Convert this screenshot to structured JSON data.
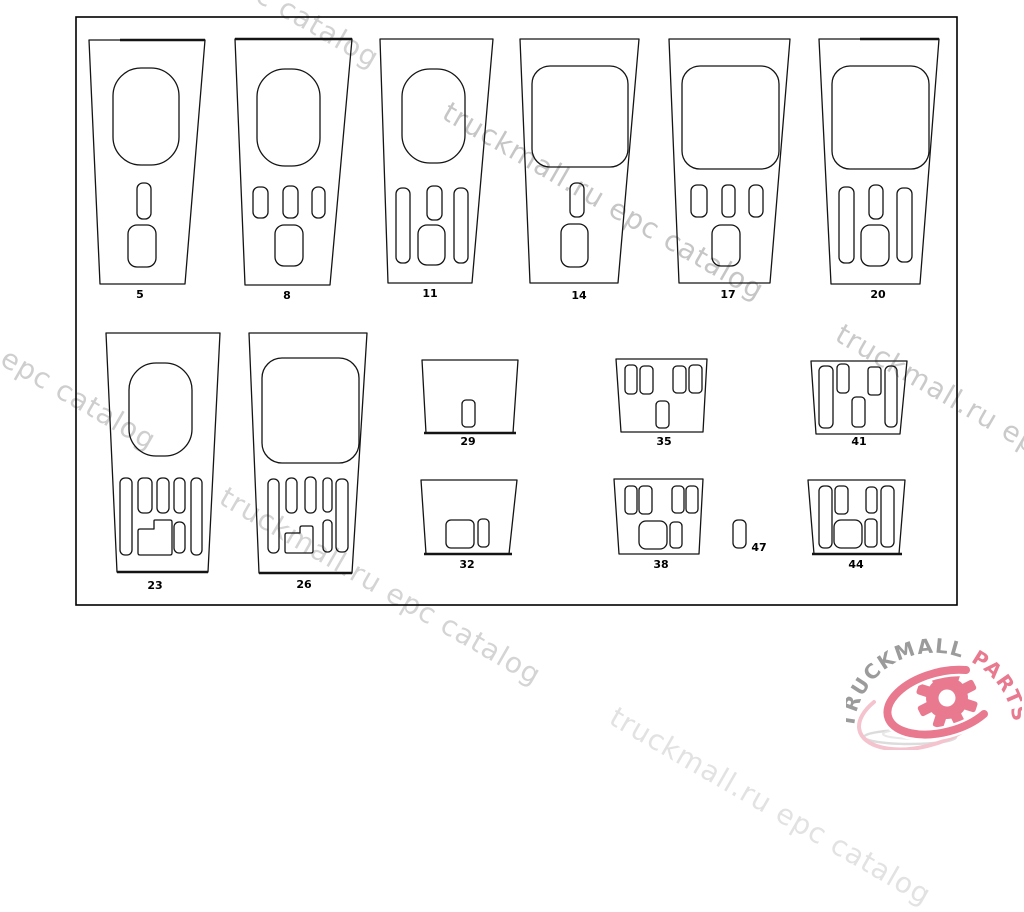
{
  "page": {
    "background": "#ffffff"
  },
  "watermark": {
    "text": "truckmall.ru epc catalog",
    "font_size": 28,
    "angle_deg": 30,
    "instances": [
      {
        "x": 60,
        "y": -122,
        "color": "#d2d2d2"
      },
      {
        "x": 445,
        "y": 110,
        "color": "#c6c6c6"
      },
      {
        "x": -163,
        "y": 260,
        "color": "#cecece"
      },
      {
        "x": 838,
        "y": 332,
        "color": "#cacaca"
      },
      {
        "x": 222,
        "y": 495,
        "color": "#d4d4d4"
      },
      {
        "x": 612,
        "y": 715,
        "color": "#e2e2e2"
      }
    ]
  },
  "logo": {
    "text_gray": "TRUCKMALL",
    "text_pink": "PARTS",
    "gray": "#9b9b9b",
    "pink": "#e8798f",
    "swirl_light": "#f4c3cd",
    "shadow": "#dcdcdc"
  },
  "diagram": {
    "border": {
      "x": 76,
      "y": 17,
      "w": 881,
      "h": 588,
      "stroke": "#000000"
    },
    "line_color": "#141414",
    "label_font_size": 11,
    "panels": [
      {
        "id": "5",
        "label": "5",
        "label_x": 140,
        "label_y": 298,
        "outline": [
          [
            89,
            40
          ],
          [
            205,
            40
          ],
          [
            185,
            284
          ],
          [
            100,
            284
          ]
        ],
        "thick": [
          [
            120,
            40,
            205,
            40
          ]
        ],
        "cutouts": [
          {
            "t": "rect",
            "x": 113,
            "y": 68,
            "w": 66,
            "h": 97,
            "rx": 28
          },
          {
            "t": "rect",
            "x": 137,
            "y": 183,
            "w": 14,
            "h": 36,
            "rx": 6
          },
          {
            "t": "rect",
            "x": 128,
            "y": 225,
            "w": 28,
            "h": 42,
            "rx": 9
          }
        ]
      },
      {
        "id": "8",
        "label": "8",
        "label_x": 287,
        "label_y": 299,
        "outline": [
          [
            235,
            39
          ],
          [
            352,
            39
          ],
          [
            330,
            285
          ],
          [
            245,
            285
          ]
        ],
        "thick": [
          [
            235,
            39,
            352,
            39
          ]
        ],
        "cutouts": [
          {
            "t": "rect",
            "x": 257,
            "y": 69,
            "w": 63,
            "h": 97,
            "rx": 28
          },
          {
            "t": "rect",
            "x": 253,
            "y": 187,
            "w": 15,
            "h": 31,
            "rx": 6
          },
          {
            "t": "rect",
            "x": 283,
            "y": 186,
            "w": 15,
            "h": 32,
            "rx": 6
          },
          {
            "t": "rect",
            "x": 312,
            "y": 187,
            "w": 13,
            "h": 31,
            "rx": 6
          },
          {
            "t": "rect",
            "x": 275,
            "y": 225,
            "w": 28,
            "h": 41,
            "rx": 9
          }
        ]
      },
      {
        "id": "11",
        "label": "11",
        "label_x": 430,
        "label_y": 297,
        "outline": [
          [
            380,
            39
          ],
          [
            493,
            39
          ],
          [
            472,
            283
          ],
          [
            388,
            283
          ]
        ],
        "cutouts": [
          {
            "t": "rect",
            "x": 402,
            "y": 69,
            "w": 63,
            "h": 94,
            "rx": 28
          },
          {
            "t": "rect",
            "x": 396,
            "y": 188,
            "w": 14,
            "h": 75,
            "rx": 6
          },
          {
            "t": "rect",
            "x": 427,
            "y": 186,
            "w": 15,
            "h": 34,
            "rx": 6
          },
          {
            "t": "rect",
            "x": 454,
            "y": 188,
            "w": 14,
            "h": 75,
            "rx": 6
          },
          {
            "t": "rect",
            "x": 418,
            "y": 225,
            "w": 27,
            "h": 40,
            "rx": 9
          }
        ]
      },
      {
        "id": "14",
        "label": "14",
        "label_x": 579,
        "label_y": 299,
        "outline": [
          [
            520,
            39
          ],
          [
            639,
            39
          ],
          [
            618,
            283
          ],
          [
            530,
            283
          ]
        ],
        "cutouts": [
          {
            "t": "rect",
            "x": 532,
            "y": 66,
            "w": 96,
            "h": 101,
            "rx": 18
          },
          {
            "t": "rect",
            "x": 570,
            "y": 183,
            "w": 14,
            "h": 34,
            "rx": 6
          },
          {
            "t": "rect",
            "x": 561,
            "y": 224,
            "w": 27,
            "h": 43,
            "rx": 9
          }
        ]
      },
      {
        "id": "17",
        "label": "17",
        "label_x": 728,
        "label_y": 298,
        "outline": [
          [
            669,
            39
          ],
          [
            790,
            39
          ],
          [
            770,
            283
          ],
          [
            679,
            283
          ]
        ],
        "cutouts": [
          {
            "t": "rect",
            "x": 682,
            "y": 66,
            "w": 97,
            "h": 103,
            "rx": 18
          },
          {
            "t": "rect",
            "x": 691,
            "y": 185,
            "w": 16,
            "h": 32,
            "rx": 6
          },
          {
            "t": "rect",
            "x": 722,
            "y": 185,
            "w": 13,
            "h": 32,
            "rx": 5
          },
          {
            "t": "rect",
            "x": 749,
            "y": 185,
            "w": 14,
            "h": 32,
            "rx": 6
          },
          {
            "t": "rect",
            "x": 712,
            "y": 225,
            "w": 28,
            "h": 41,
            "rx": 9
          }
        ]
      },
      {
        "id": "20",
        "label": "20",
        "label_x": 878,
        "label_y": 298,
        "outline": [
          [
            819,
            39
          ],
          [
            939,
            39
          ],
          [
            920,
            284
          ],
          [
            831,
            284
          ]
        ],
        "thick": [
          [
            860,
            39,
            939,
            39
          ]
        ],
        "cutouts": [
          {
            "t": "rect",
            "x": 832,
            "y": 66,
            "w": 97,
            "h": 103,
            "rx": 18
          },
          {
            "t": "rect",
            "x": 839,
            "y": 187,
            "w": 15,
            "h": 76,
            "rx": 6
          },
          {
            "t": "rect",
            "x": 869,
            "y": 185,
            "w": 14,
            "h": 34,
            "rx": 6
          },
          {
            "t": "rect",
            "x": 897,
            "y": 188,
            "w": 15,
            "h": 74,
            "rx": 6
          },
          {
            "t": "rect",
            "x": 861,
            "y": 225,
            "w": 28,
            "h": 41,
            "rx": 9
          }
        ]
      },
      {
        "id": "23",
        "label": "23",
        "label_x": 155,
        "label_y": 589,
        "outline": [
          [
            106,
            333
          ],
          [
            220,
            333
          ],
          [
            208,
            572
          ],
          [
            117,
            572
          ]
        ],
        "thick": [
          [
            117,
            572,
            208,
            572
          ]
        ],
        "cutouts": [
          {
            "t": "rect",
            "x": 129,
            "y": 363,
            "w": 63,
            "h": 93,
            "rx": 27
          },
          {
            "t": "rect",
            "x": 120,
            "y": 478,
            "w": 12,
            "h": 77,
            "rx": 5
          },
          {
            "t": "rect",
            "x": 138,
            "y": 478,
            "w": 14,
            "h": 35,
            "rx": 5
          },
          {
            "t": "rect",
            "x": 157,
            "y": 478,
            "w": 12,
            "h": 35,
            "rx": 5
          },
          {
            "t": "rect",
            "x": 174,
            "y": 478,
            "w": 11,
            "h": 35,
            "rx": 5
          },
          {
            "t": "rect",
            "x": 191,
            "y": 478,
            "w": 11,
            "h": 77,
            "rx": 5
          },
          {
            "t": "rect",
            "x": 174,
            "y": 522,
            "w": 11,
            "h": 31,
            "rx": 5
          },
          {
            "t": "path",
            "d": "M 140,529 L 154,529 L 154,521 Q 154,520 155,520 L 170,520 Q 172,520 172,522 L 172,553 Q 172,555 170,555 L 140,555 Q 138,555 138,553 L 138,531 Q 138,529 140,529 Z"
          }
        ]
      },
      {
        "id": "26",
        "label": "26",
        "label_x": 304,
        "label_y": 588,
        "outline": [
          [
            249,
            333
          ],
          [
            367,
            333
          ],
          [
            352,
            573
          ],
          [
            259,
            573
          ]
        ],
        "thick": [
          [
            259,
            573,
            352,
            573
          ]
        ],
        "cutouts": [
          {
            "t": "rect",
            "x": 262,
            "y": 358,
            "w": 97,
            "h": 105,
            "rx": 20
          },
          {
            "t": "rect",
            "x": 268,
            "y": 479,
            "w": 11,
            "h": 74,
            "rx": 5
          },
          {
            "t": "rect",
            "x": 286,
            "y": 478,
            "w": 11,
            "h": 35,
            "rx": 5
          },
          {
            "t": "rect",
            "x": 305,
            "y": 477,
            "w": 11,
            "h": 36,
            "rx": 5
          },
          {
            "t": "rect",
            "x": 323,
            "y": 478,
            "w": 9,
            "h": 34,
            "rx": 4
          },
          {
            "t": "rect",
            "x": 336,
            "y": 479,
            "w": 12,
            "h": 73,
            "rx": 5
          },
          {
            "t": "rect",
            "x": 323,
            "y": 520,
            "w": 9,
            "h": 32,
            "rx": 4
          },
          {
            "t": "path",
            "d": "M 287,533 L 300,533 L 300,528 Q 300,526 302,526 L 311,526 Q 313,526 313,528 L 313,551 Q 313,553 311,553 L 287,553 Q 285,553 285,551 L 285,535 Q 285,533 287,533 Z"
          }
        ]
      },
      {
        "id": "29",
        "label": "29",
        "label_x": 468,
        "label_y": 445,
        "outline": [
          [
            422,
            360
          ],
          [
            518,
            360
          ],
          [
            513,
            433
          ],
          [
            426,
            433
          ]
        ],
        "thick": [
          [
            424,
            433,
            516,
            433
          ]
        ],
        "cutouts": [
          {
            "t": "rect",
            "x": 462,
            "y": 400,
            "w": 13,
            "h": 27,
            "rx": 4
          }
        ]
      },
      {
        "id": "35",
        "label": "35",
        "label_x": 664,
        "label_y": 445,
        "outline": [
          [
            616,
            359
          ],
          [
            707,
            359
          ],
          [
            703,
            432
          ],
          [
            621,
            432
          ]
        ],
        "cutouts": [
          {
            "t": "rect",
            "x": 625,
            "y": 365,
            "w": 12,
            "h": 29,
            "rx": 4
          },
          {
            "t": "rect",
            "x": 640,
            "y": 366,
            "w": 13,
            "h": 28,
            "rx": 4
          },
          {
            "t": "rect",
            "x": 673,
            "y": 366,
            "w": 13,
            "h": 27,
            "rx": 4
          },
          {
            "t": "rect",
            "x": 689,
            "y": 365,
            "w": 13,
            "h": 28,
            "rx": 4
          },
          {
            "t": "rect",
            "x": 656,
            "y": 401,
            "w": 13,
            "h": 27,
            "rx": 4
          }
        ]
      },
      {
        "id": "41",
        "label": "41",
        "label_x": 859,
        "label_y": 445,
        "outline": [
          [
            811,
            361
          ],
          [
            907,
            361
          ],
          [
            900,
            434
          ],
          [
            816,
            434
          ]
        ],
        "cutouts": [
          {
            "t": "rect",
            "x": 819,
            "y": 366,
            "w": 14,
            "h": 62,
            "rx": 5
          },
          {
            "t": "rect",
            "x": 837,
            "y": 364,
            "w": 12,
            "h": 29,
            "rx": 4
          },
          {
            "t": "rect",
            "x": 852,
            "y": 397,
            "w": 13,
            "h": 30,
            "rx": 4
          },
          {
            "t": "rect",
            "x": 868,
            "y": 367,
            "w": 13,
            "h": 28,
            "rx": 3
          },
          {
            "t": "rect",
            "x": 885,
            "y": 366,
            "w": 12,
            "h": 61,
            "rx": 5
          }
        ]
      },
      {
        "id": "32",
        "label": "32",
        "label_x": 467,
        "label_y": 568,
        "outline": [
          [
            421,
            480
          ],
          [
            517,
            480
          ],
          [
            509,
            554
          ],
          [
            426,
            554
          ]
        ],
        "thick": [
          [
            424,
            554,
            512,
            554
          ]
        ],
        "cutouts": [
          {
            "t": "rect",
            "x": 446,
            "y": 520,
            "w": 28,
            "h": 28,
            "rx": 5
          },
          {
            "t": "rect",
            "x": 478,
            "y": 519,
            "w": 11,
            "h": 28,
            "rx": 4
          }
        ]
      },
      {
        "id": "38",
        "label": "38",
        "label_x": 661,
        "label_y": 568,
        "outline": [
          [
            614,
            479
          ],
          [
            703,
            479
          ],
          [
            699,
            554
          ],
          [
            619,
            554
          ]
        ],
        "cutouts": [
          {
            "t": "rect",
            "x": 625,
            "y": 486,
            "w": 12,
            "h": 28,
            "rx": 4
          },
          {
            "t": "rect",
            "x": 639,
            "y": 486,
            "w": 13,
            "h": 28,
            "rx": 4
          },
          {
            "t": "rect",
            "x": 672,
            "y": 486,
            "w": 12,
            "h": 27,
            "rx": 4
          },
          {
            "t": "rect",
            "x": 686,
            "y": 486,
            "w": 12,
            "h": 27,
            "rx": 4
          },
          {
            "t": "rect",
            "x": 639,
            "y": 521,
            "w": 28,
            "h": 28,
            "rx": 7
          },
          {
            "t": "rect",
            "x": 670,
            "y": 522,
            "w": 12,
            "h": 26,
            "rx": 4
          }
        ]
      },
      {
        "id": "47",
        "label": "47",
        "label_x": 759,
        "label_y": 551,
        "outline": null,
        "cutouts": [
          {
            "t": "rect",
            "x": 733,
            "y": 520,
            "w": 13,
            "h": 28,
            "rx": 5
          }
        ]
      },
      {
        "id": "44",
        "label": "44",
        "label_x": 856,
        "label_y": 568,
        "outline": [
          [
            808,
            480
          ],
          [
            905,
            480
          ],
          [
            899,
            554
          ],
          [
            814,
            554
          ]
        ],
        "thick": [
          [
            812,
            554,
            902,
            554
          ]
        ],
        "cutouts": [
          {
            "t": "rect",
            "x": 819,
            "y": 486,
            "w": 13,
            "h": 62,
            "rx": 5
          },
          {
            "t": "rect",
            "x": 835,
            "y": 486,
            "w": 13,
            "h": 28,
            "rx": 4
          },
          {
            "t": "rect",
            "x": 866,
            "y": 487,
            "w": 11,
            "h": 26,
            "rx": 4
          },
          {
            "t": "rect",
            "x": 881,
            "y": 486,
            "w": 13,
            "h": 61,
            "rx": 5
          },
          {
            "t": "rect",
            "x": 834,
            "y": 520,
            "w": 28,
            "h": 28,
            "rx": 7
          },
          {
            "t": "rect",
            "x": 865,
            "y": 519,
            "w": 12,
            "h": 28,
            "rx": 4
          }
        ]
      }
    ]
  }
}
